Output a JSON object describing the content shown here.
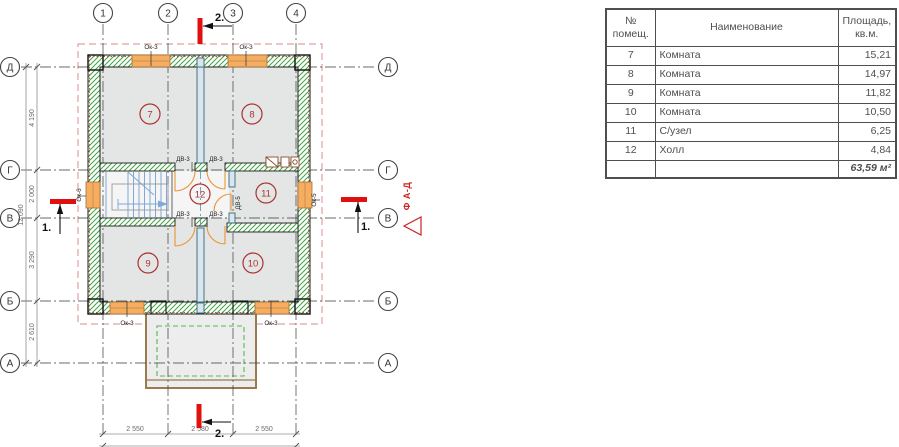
{
  "plan": {
    "column_axes": [
      "1",
      "2",
      "3",
      "4"
    ],
    "row_axes": [
      "Д",
      "Г",
      "В",
      "Б",
      "А"
    ],
    "room_numbers": {
      "room7": "7",
      "room8": "8",
      "room9": "9",
      "room10": "10",
      "room11": "11",
      "room12": "12"
    },
    "window_labels": {
      "top_left": "Ок-3",
      "top_right": "Ок-3",
      "bottom_left": "Ок-3",
      "bottom_right": "Ок-3",
      "left": "Ок-6",
      "right": "Ок-5"
    },
    "door_labels": {
      "hall_top_left": "ДВ-3",
      "hall_top_right": "ДВ-3",
      "hall_bottom_left": "ДВ-3",
      "hall_bottom_right": "ДВ-3",
      "bathroom": "ДВ-5"
    },
    "section_marks": {
      "top": "2.",
      "bottom": "2.",
      "left": "1.",
      "right": "1."
    },
    "facade_label": "Ф А-Д",
    "dimensions": {
      "left_spans": [
        "4 190",
        "2 000",
        "3 290",
        "2 610"
      ],
      "left_total": "12 090",
      "bottom_spans": [
        "2 550",
        "2 580",
        "2 550"
      ],
      "bottom_total": "7 680"
    }
  },
  "table": {
    "header": {
      "num": "№\nпомещ.",
      "name": "Наименование",
      "area": "Площадь,\nкв.м."
    },
    "rows": [
      {
        "num": "7",
        "name": "Комната",
        "area": "15,21"
      },
      {
        "num": "8",
        "name": "Комната",
        "area": "14,97"
      },
      {
        "num": "9",
        "name": "Комната",
        "area": "11,82"
      },
      {
        "num": "10",
        "name": "Комната",
        "area": "10,50"
      },
      {
        "num": "11",
        "name": "С/узел",
        "area": "6,25"
      },
      {
        "num": "12",
        "name": "Холл",
        "area": "4,84"
      }
    ],
    "total_area": "63,59 м²"
  },
  "colors": {
    "wall_hatch": "#3fa33f",
    "window": "#f5ad62",
    "door": "#ec9433",
    "room_badge": "#ab3232",
    "section_red": "#e01010",
    "roof_dash": "#d98c8c",
    "porch": "#9a7b4f",
    "stairs": "#7fa8d8",
    "partition": "#37667a"
  }
}
